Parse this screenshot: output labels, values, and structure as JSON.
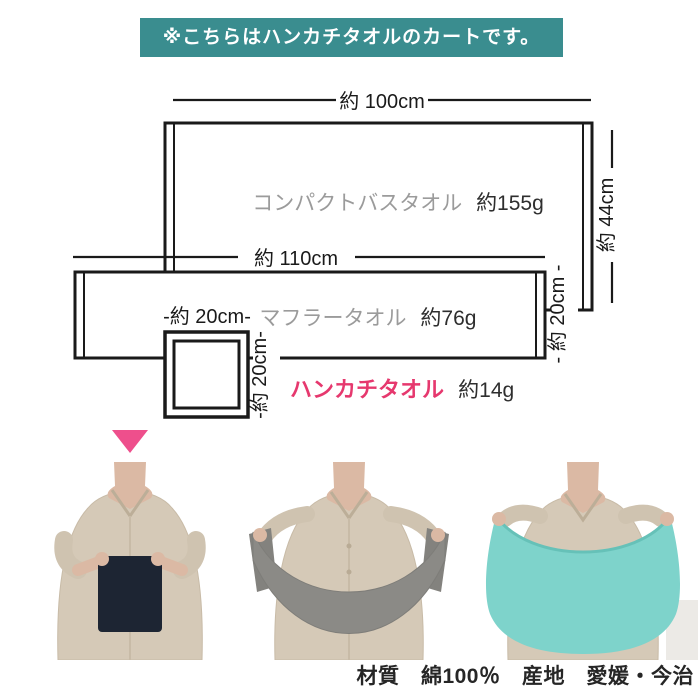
{
  "banner": {
    "text": "※こちらはハンカチタオルのカートです。",
    "bg_color": "#3a8d8f",
    "text_color": "#ffffff"
  },
  "diagram": {
    "bath": {
      "name": "コンパクトバスタオル",
      "weight": "約155g",
      "width_label": "約 100cm",
      "height_label": "約 44cm"
    },
    "muffler": {
      "name": "マフラータオル",
      "weight": "約76g",
      "width_label": "約 110cm",
      "height_label": "- 約 20cm -"
    },
    "handkerchief": {
      "name": "ハンカチタオル",
      "weight": "約14g",
      "width_label": "-約 20cm-",
      "height_label": "-約 20cm-"
    }
  },
  "colors": {
    "line": "#1a1a1a",
    "towel_name_gray": "#9b9b9b",
    "accent_pink": "#e6386e",
    "arrow_pink": "#ee4f8c",
    "photo_handkerchief_towel": "#1d2533",
    "photo_muffler_towel": "#8b8a86",
    "photo_bath_towel": "#7ed3cb",
    "shirt_beige": "#d5c9b7",
    "skin": "#dbb9a4"
  },
  "footer": {
    "text": "材質　綿100％　産地　愛媛・今治"
  }
}
